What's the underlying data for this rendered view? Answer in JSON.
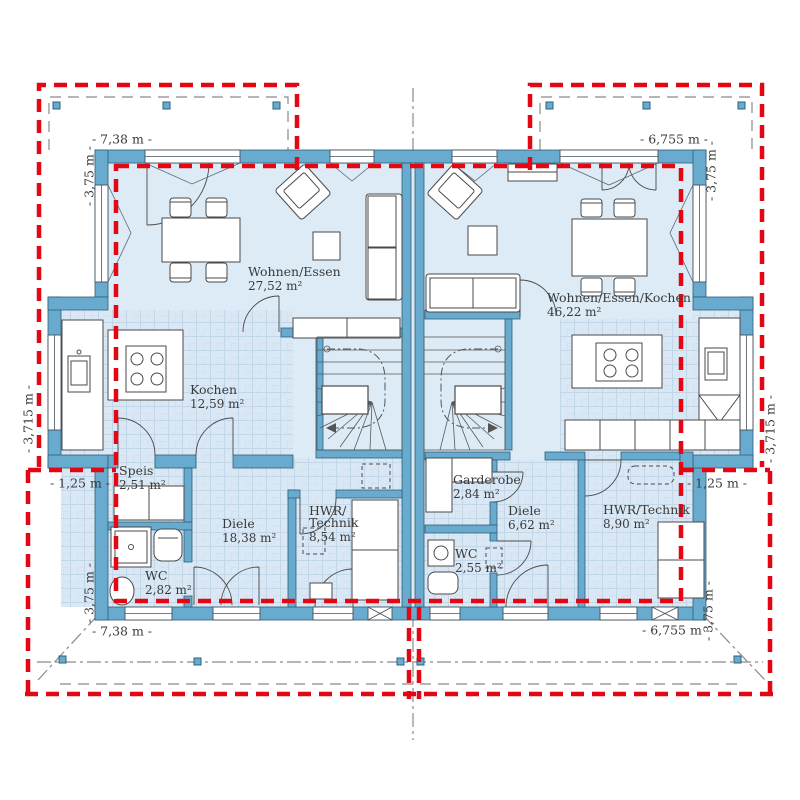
{
  "plan": {
    "type": "floor-plan",
    "building": "semi-detached-house-ground-floor",
    "units": {
      "left": {
        "wohnen_essen": {
          "name": "Wohnen/Essen",
          "area": "27,52 m²"
        },
        "kochen": {
          "name": "Kochen",
          "area": "12,59 m²"
        },
        "speis": {
          "name": "Speis",
          "area": "2,51 m²"
        },
        "diele": {
          "name": "Diele",
          "area": "18,38 m²"
        },
        "hwr": {
          "name1": "HWR/",
          "name2": "Technik",
          "area": "8,54 m²"
        },
        "wc": {
          "name": "WC",
          "area": "2,82 m²"
        }
      },
      "right": {
        "wohnen_essen_kochen": {
          "name": "Wohnen/Essen/Kochen",
          "area": "46,22 m²"
        },
        "garderobe": {
          "name": "Garderobe",
          "area": "2,84 m²"
        },
        "diele": {
          "name": "Diele",
          "area": "6,62 m²"
        },
        "wc": {
          "name": "WC",
          "area": "2,55 m²"
        },
        "hwr": {
          "name": "HWR/Technik",
          "area": "8,90 m²"
        }
      }
    },
    "dimensions": {
      "top_left": "- 7,38 m -",
      "top_right": "- 6,755 m -",
      "bottom_left": "- 7,38 m -",
      "bottom_right": "- 6,755 m -",
      "left_upper": "- 3,75 m -",
      "left_middle": "- 3,715 m -",
      "left_lower": "- 1,25 m -",
      "left_bottom": "- 3,75 m -",
      "right_upper": "- 3,75 m -",
      "right_middle": "- 3,715 m -",
      "right_lower": "- 1,25 m -",
      "right_bottom": "- 3,75 m -"
    },
    "colors": {
      "wall": "#68abce",
      "wall_edge": "#2f6079",
      "floor": "#dcebf6",
      "tileline": "#c2d8e9",
      "red": "#e30613",
      "site": "#8a8a8a",
      "ink": "#3a3a3a"
    }
  }
}
